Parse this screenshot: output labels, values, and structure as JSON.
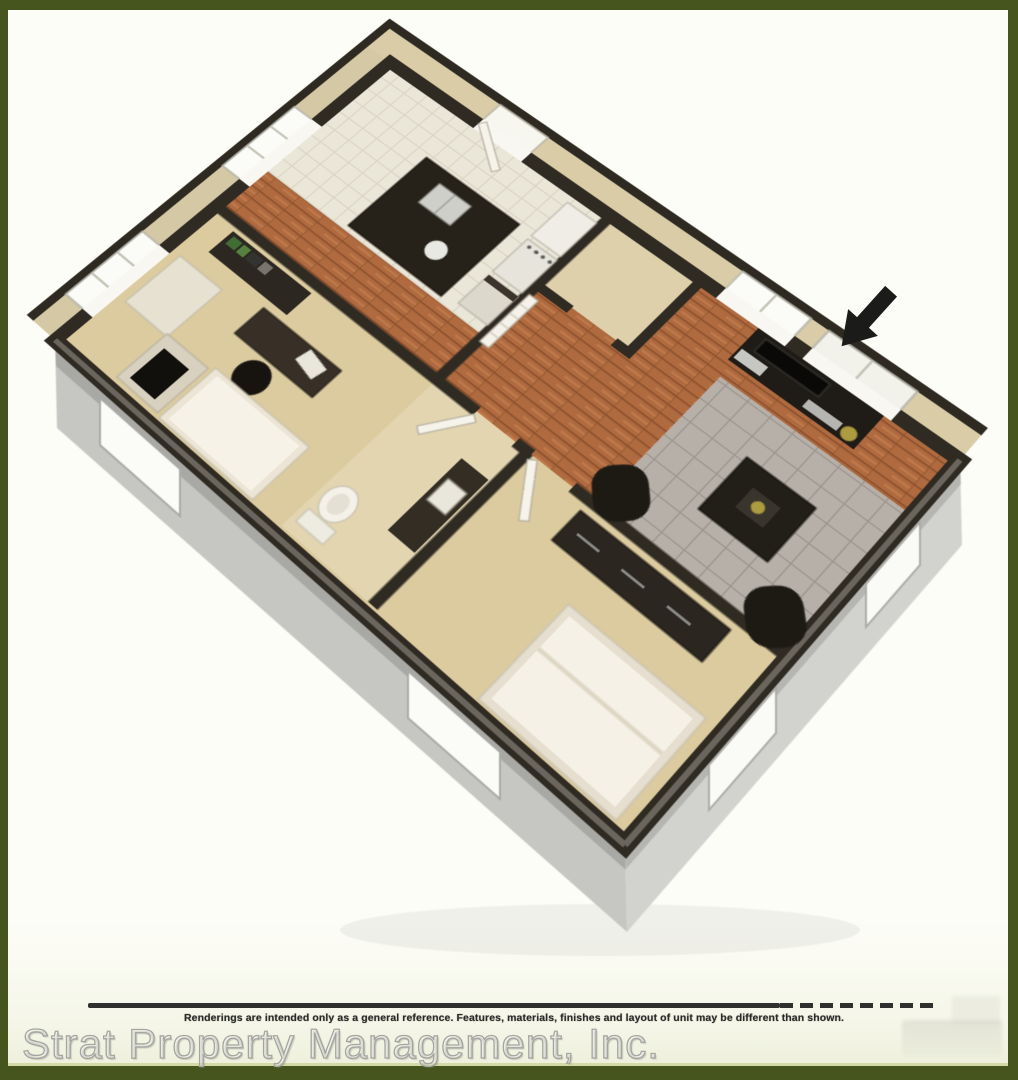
{
  "frame": {
    "border_color": "#46551d",
    "border_highlight": "#c9d393",
    "canvas_background": "#fdfdf8"
  },
  "floor_plan": {
    "kind": "3d-isometric-cutaway-apartment-floor-plan",
    "entry_arrow_icon": "arrow-down-left",
    "colors": {
      "wall_outline": "#2f2a22",
      "wall_tan_band": "#d5c8a4",
      "carpet_tan": "#dbcb9f",
      "wood_floor": "#b06a3f",
      "kitchen_tile": "#eae6d8",
      "dining_tile_gray": "#b6b0a8",
      "bath_floor": "#e3d5b0",
      "slab_gray": "#c6c6c3",
      "arrow_black": "#1b1b19",
      "furniture_dark": "#24201a",
      "accent_gold": "#ad9b3f",
      "shelf_green": "#4a7a3a"
    }
  },
  "footer": {
    "rule_color": "#30302e",
    "disclaimer": "Renderings are intended only as a general reference. Features, materials, finishes and layout of unit may be different than shown.",
    "watermark": "Strat Property Management, Inc."
  }
}
